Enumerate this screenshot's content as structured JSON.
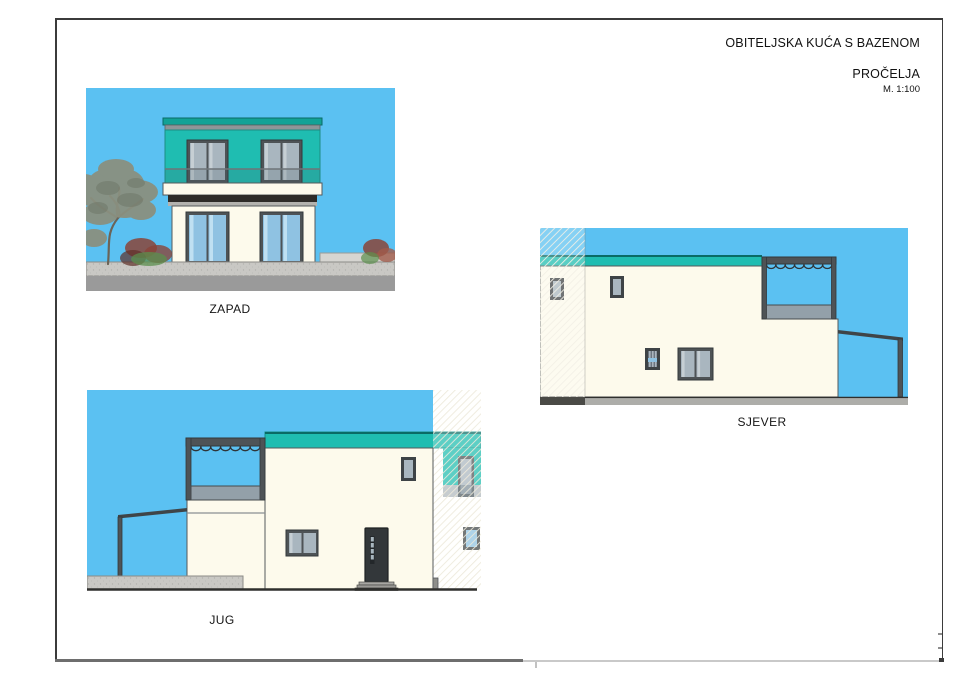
{
  "title_block": {
    "project_title": "OBITELJSKA KUĆA S BAZENOM",
    "sheet_title": "PROČELJA",
    "scale": "M. 1:100"
  },
  "elevations": {
    "zapad": {
      "label": "ZAPAD"
    },
    "jug": {
      "label": "JUG"
    },
    "sjever": {
      "label": "SJEVER"
    }
  },
  "colors": {
    "sky": "#5BC1F2",
    "teal": "#1FBDB1",
    "teal_dark": "#12A296",
    "teal_edge": "#0A6B66",
    "cream": "#FDFAEC",
    "frame": "#4E5356",
    "frame_light": "#8E9598",
    "glass_blue": "#8FC2E2",
    "glass_blue_light": "#BFE0F2",
    "glass_gray": "#A9B6BF",
    "glass_gray_light": "#C6CFD4",
    "awning": "#2E2B28",
    "concrete": "#C9C8C4",
    "ground": "#9A9A9A",
    "parapet": "#93A0A9",
    "door": "#33373A",
    "hatch": "#EDE9DB",
    "ink": "#3B3B3B",
    "outline": "#55595C",
    "foliage": "#8A9080",
    "foliage_dark": "#6F7768",
    "branch": "#6B6458",
    "shrub_red": "#8A4438",
    "shrub_green": "#5B8F4D",
    "ground_line": "#2F2F2D"
  }
}
